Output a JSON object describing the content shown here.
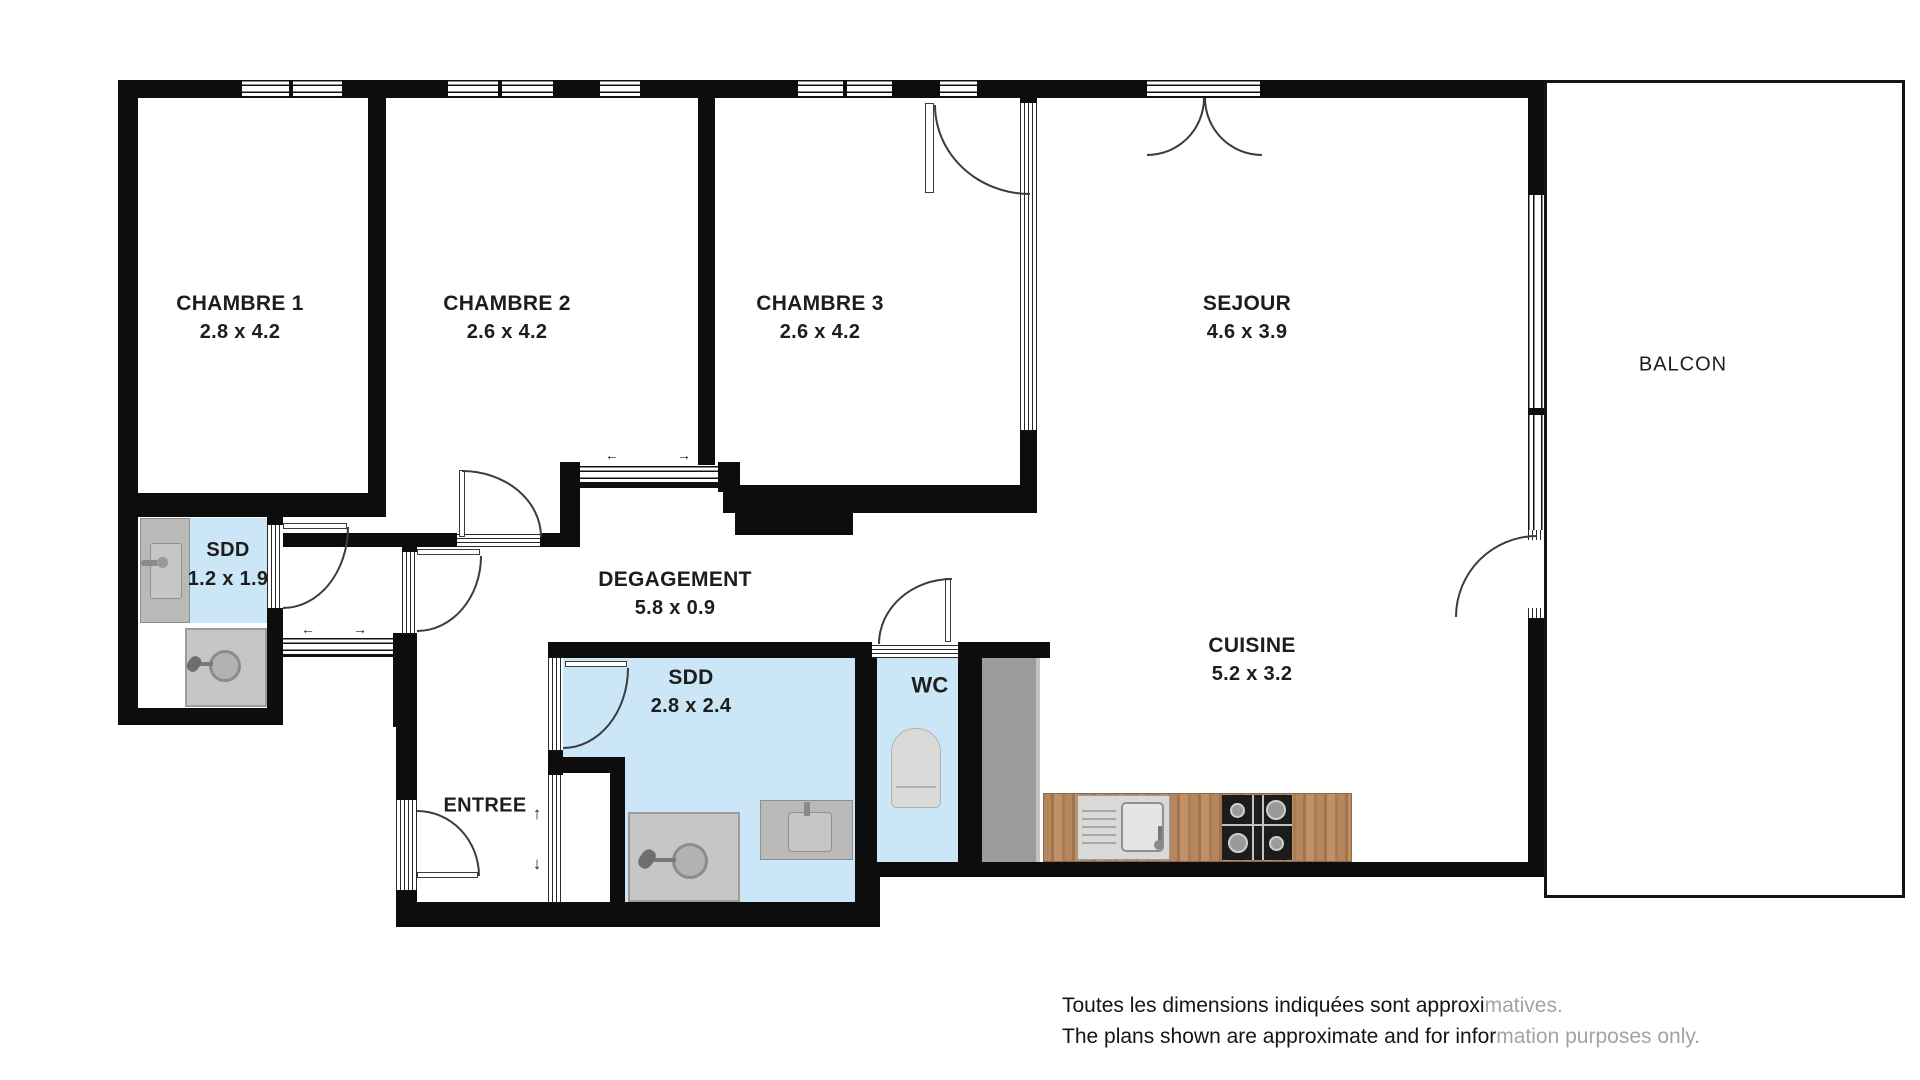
{
  "rooms": {
    "chambre1": {
      "name": "CHAMBRE 1",
      "dims": "2.8 x 4.2"
    },
    "chambre2": {
      "name": "CHAMBRE 2",
      "dims": "2.6 x 4.2"
    },
    "chambre3": {
      "name": "CHAMBRE 3",
      "dims": "2.6 x 4.2"
    },
    "sejour": {
      "name": "SEJOUR",
      "dims": "4.6 x 3.9"
    },
    "balcon": {
      "name": "BALCON",
      "dims": ""
    },
    "cuisine": {
      "name": "CUISINE",
      "dims": "5.2 x 3.2"
    },
    "degagement": {
      "name": "DEGAGEMENT",
      "dims": "5.8 x 0.9"
    },
    "sdd_small": {
      "name": "SDD",
      "dims": "1.2 x 1.9"
    },
    "sdd_large": {
      "name": "SDD",
      "dims": "2.8 x 2.4"
    },
    "wc": {
      "name": "WC",
      "dims": ""
    },
    "entree": {
      "name": "ENTREE",
      "dims": ""
    }
  },
  "disclaimer": {
    "line1_dark": "Toutes les dimensions indiquées sont approxi",
    "line1_light": "matives.",
    "line2_dark": "The plans shown are approximate and for infor",
    "line2_light": "mation purposes only."
  },
  "icons": {
    "slider_left": "←",
    "slider_right": "→",
    "entry_up": "↑",
    "entry_down": "↓"
  },
  "colors": {
    "wall": "#0d0d0d",
    "bathroom_floor": "#cbe6f7",
    "fixture_gray": "#b9b9b7",
    "closet_gray": "#9b9b9b",
    "counter_wood": "#b4835a",
    "stove_black": "#1c1c1c",
    "watermark_gray": "#a3a3a3"
  }
}
